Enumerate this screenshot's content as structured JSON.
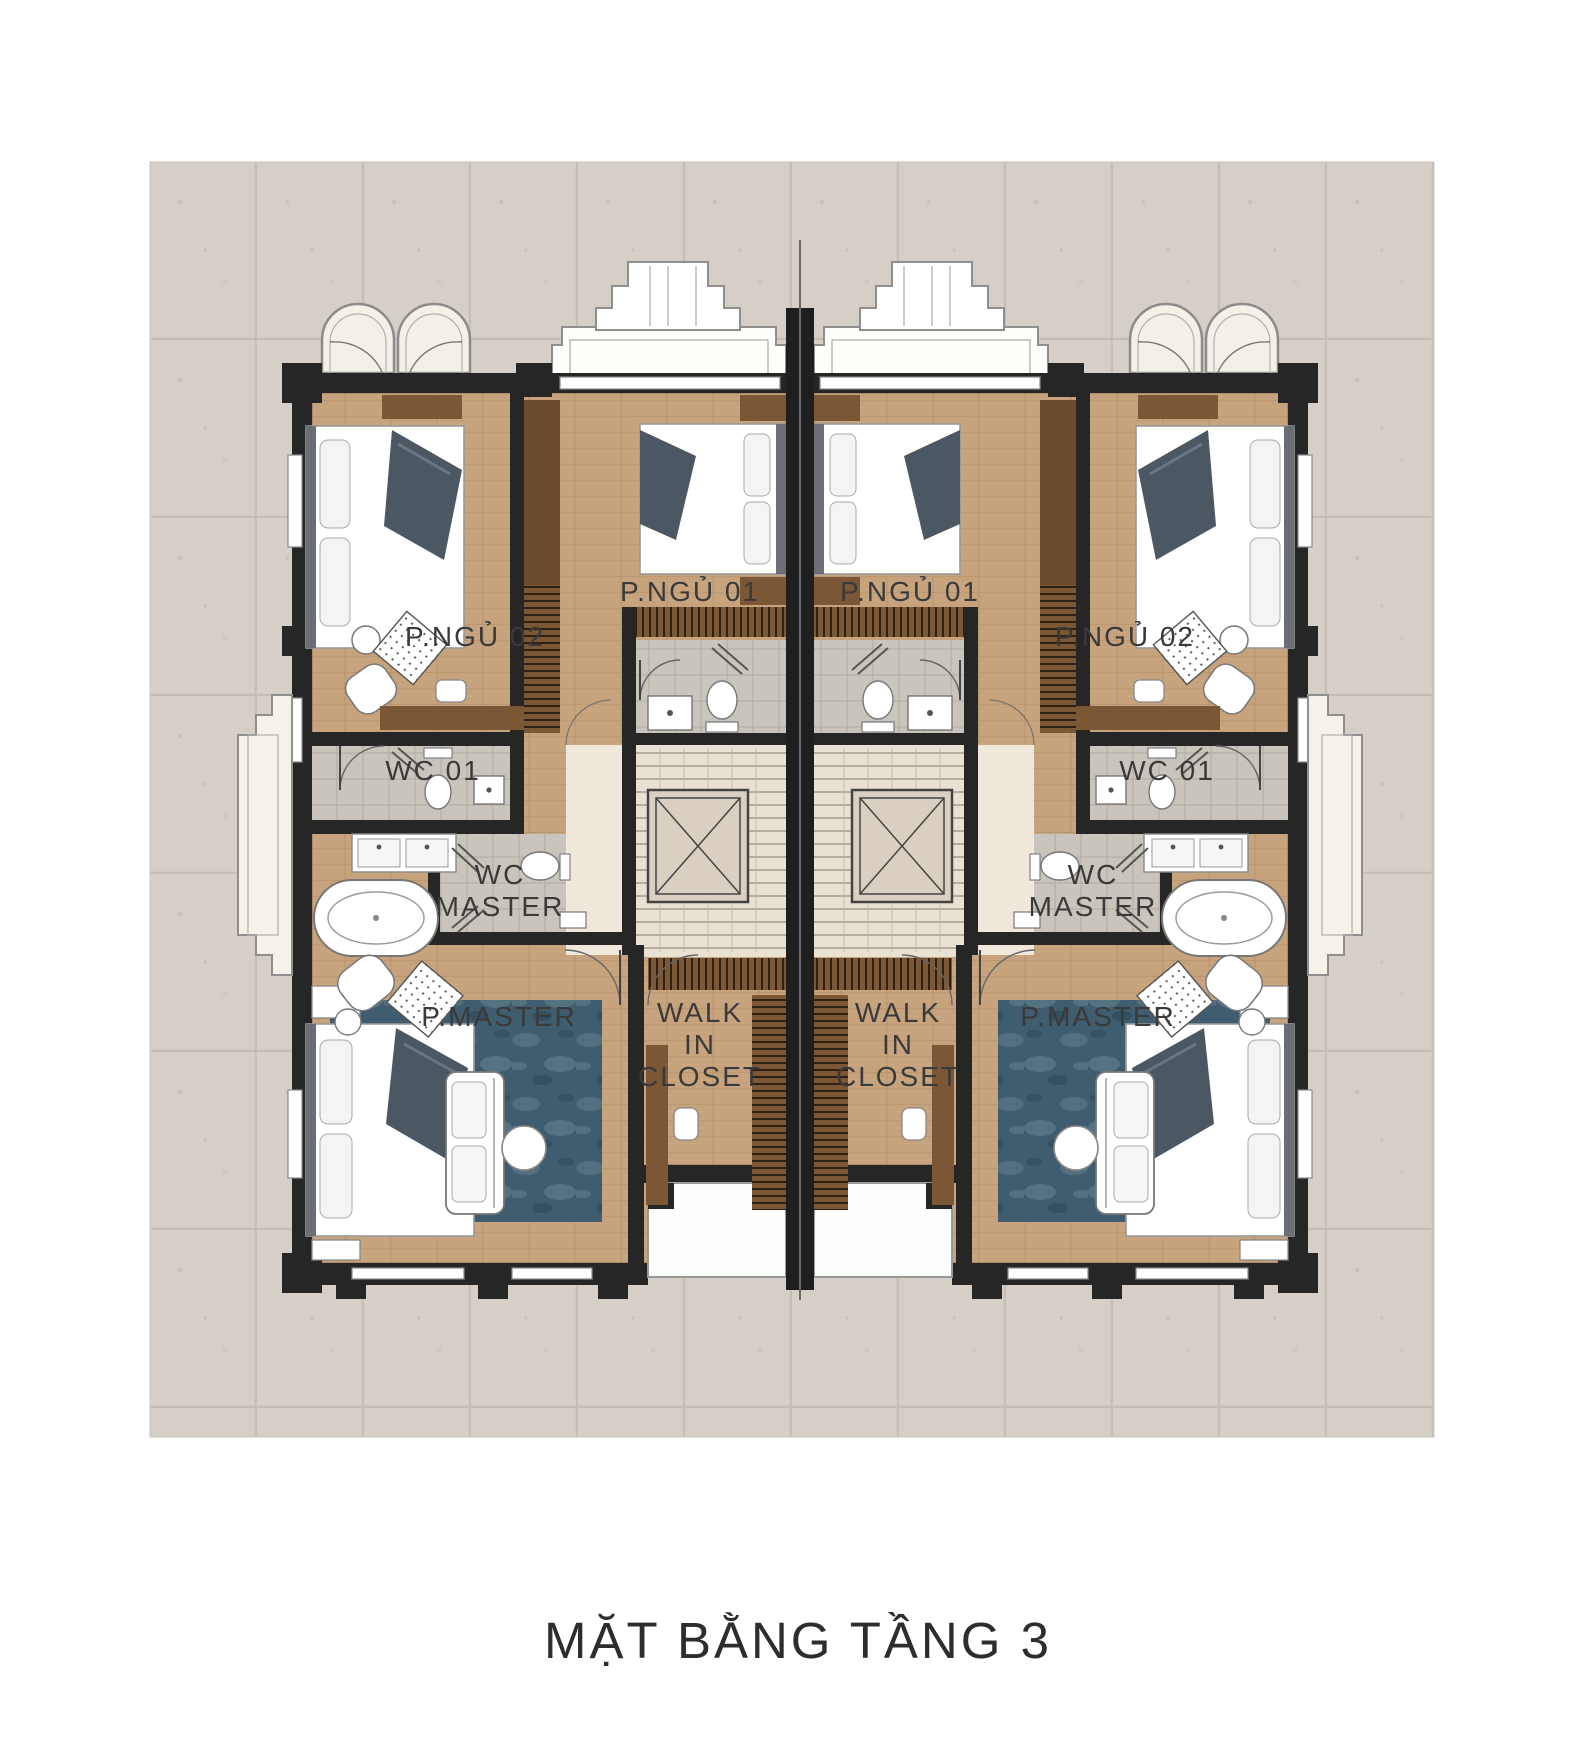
{
  "title": "MẶT BẰNG TẦNG 3",
  "labels": {
    "bedroom1": "P.NGỦ 01",
    "bedroom2": "P.NGỦ 02",
    "wc01": "WC 01",
    "wc_master_line1": "WC",
    "wc_master_line2": "MASTER",
    "p_master": "P.MASTER",
    "walkin_line1": "WALK",
    "walkin_line2": "IN",
    "walkin_line3": "CLOSET"
  },
  "colors": {
    "page_background": "#ffffff",
    "paving": "#d5cfc7",
    "paving_grout": "#c4beb5",
    "wall": "#262626",
    "wood_floor": "#c6a37d",
    "wood_dark": "#7c5735",
    "bath_tile": "#c9c4bc",
    "stair_paper": "#e8e1d4",
    "landing_cream": "#f0e9db",
    "rug_blue": "#3f5d6e",
    "furniture_white": "#ffffff",
    "blanket_gray": "#4b5864",
    "label_text": "#3a3a3a"
  }
}
